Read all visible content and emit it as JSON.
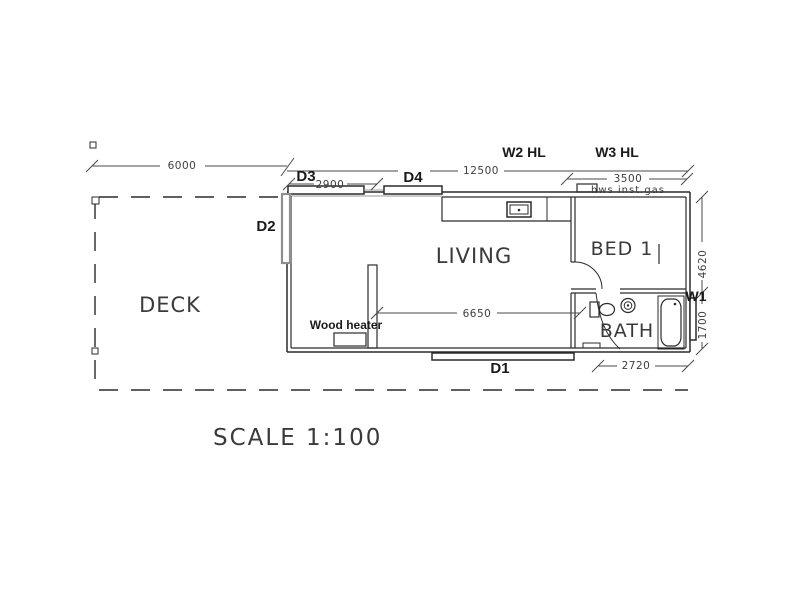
{
  "drawing": {
    "scale_note": "SCALE 1:100",
    "rooms": {
      "deck": "DECK",
      "living": "LIVING",
      "bed1": "BED 1",
      "bath": "BATH"
    },
    "doors": {
      "d1": "D1",
      "d2": "D2",
      "d3": "D3",
      "d4": "D4"
    },
    "windows": {
      "w1": "W1",
      "w2": "W2 HL",
      "w3": "W3 HL"
    },
    "fixtures": {
      "wood_heater": "Wood heater",
      "hot_water": "hws inst.gas"
    },
    "dimensions_mm": {
      "deck_length": "6000",
      "building_length": "12500",
      "d3_opening": "2900",
      "bed_wall": "3500",
      "living_width": "6650",
      "bath_width": "2720",
      "upper_depth": "4620",
      "lower_depth": "1700"
    },
    "colors": {
      "line": "#2b2b2b",
      "dimension": "#4a4a4a",
      "door_panel_gray": "#8f8f8f",
      "background": "#ffffff"
    }
  }
}
